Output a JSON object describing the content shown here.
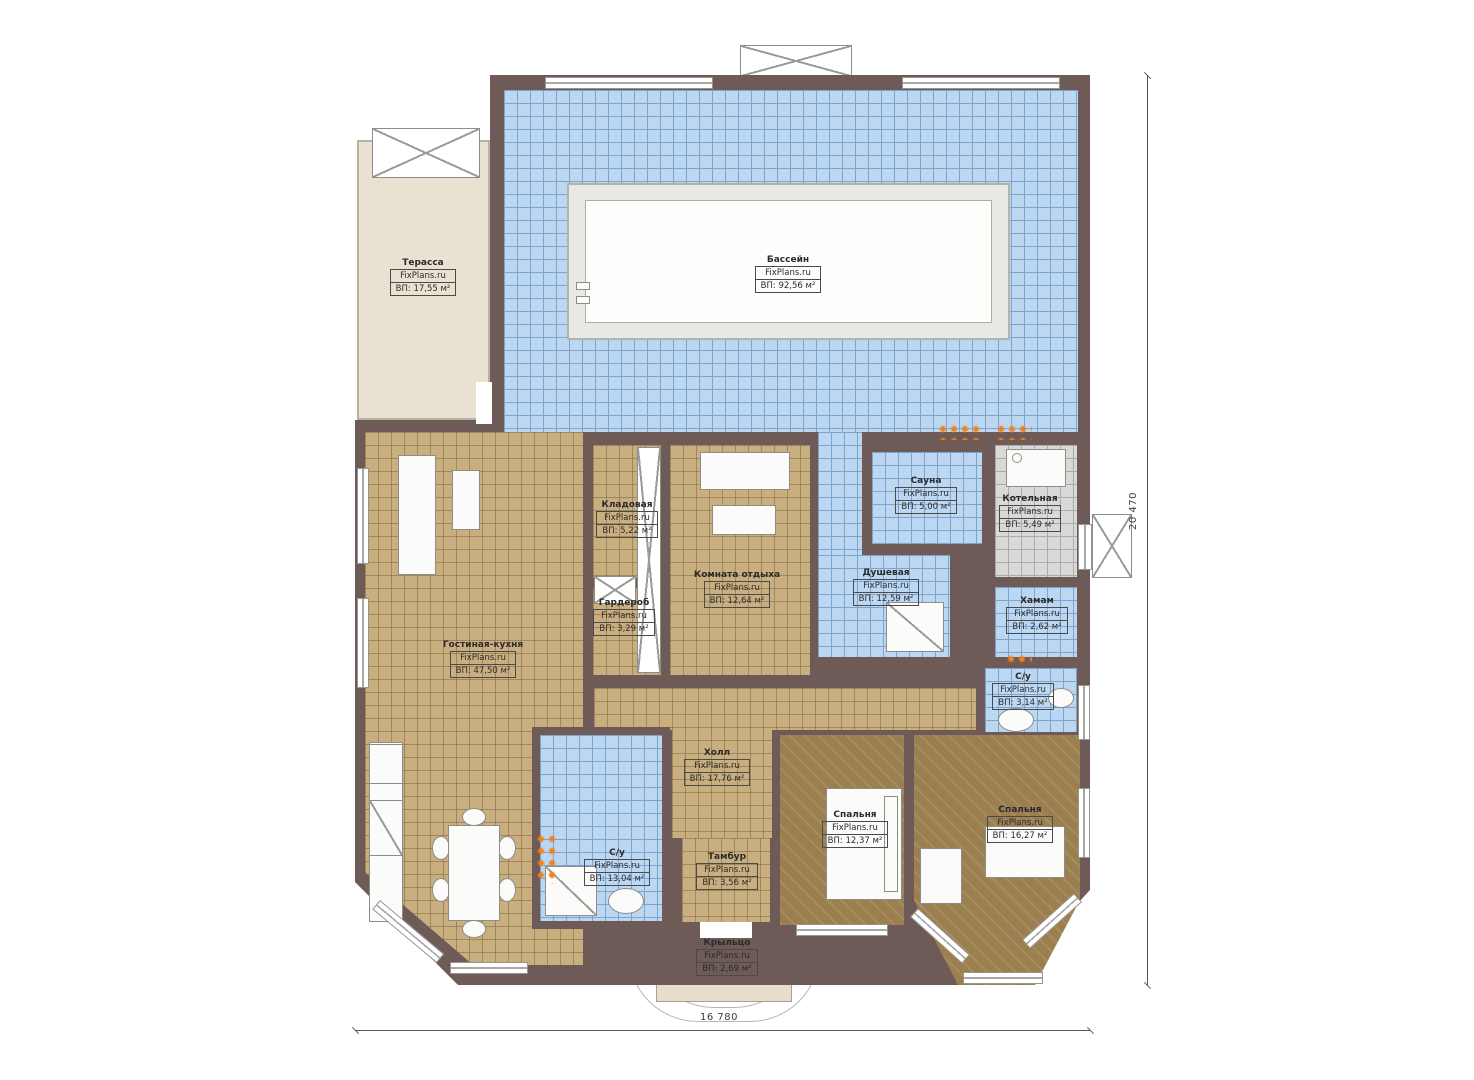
{
  "branding": {
    "site": "FixPlans.ru"
  },
  "dimensions": {
    "width_label": "16 780",
    "height_label": "20 470"
  },
  "colors": {
    "wall": "#6e5a56",
    "wet_tile": "#bcd7f1",
    "living_tile": "#c9ae80",
    "bedroom_floor": "#9c7f4f",
    "boiler_tile": "#d9d9d7",
    "terrace": "#e9e1d2",
    "radiator_dot": "#f08018"
  },
  "rooms": [
    {
      "id": "terrace",
      "name": "Терасса",
      "brand": "FixPlans.ru",
      "area": "ВП: 17,55 м²"
    },
    {
      "id": "pool",
      "name": "Бассейн",
      "brand": "FixPlans.ru",
      "area": "ВП: 92,56 м²"
    },
    {
      "id": "storage",
      "name": "Кладовая",
      "brand": "FixPlans.ru",
      "area": "ВП: 5,22 м²"
    },
    {
      "id": "lounge",
      "name": "Комната отдыха",
      "brand": "FixPlans.ru",
      "area": "ВП: 12,64 м²"
    },
    {
      "id": "sauna",
      "name": "Сауна",
      "brand": "FixPlans.ru",
      "area": "ВП: 5,00 м²"
    },
    {
      "id": "boiler",
      "name": "Котельная",
      "brand": "FixPlans.ru",
      "area": "ВП: 5,49 м²"
    },
    {
      "id": "shower",
      "name": "Душевая",
      "brand": "FixPlans.ru",
      "area": "ВП: 12,59 м²"
    },
    {
      "id": "hammam",
      "name": "Хамам",
      "brand": "FixPlans.ru",
      "area": "ВП: 2,62 м²"
    },
    {
      "id": "wardrobe",
      "name": "Гардероб",
      "brand": "FixPlans.ru",
      "area": "ВП: 3,29 м²"
    },
    {
      "id": "living",
      "name": "Гостиная-кухня",
      "brand": "FixPlans.ru",
      "area": "ВП: 47,50 м²"
    },
    {
      "id": "wc-right",
      "name": "С/у",
      "brand": "FixPlans.ru",
      "area": "ВП: 3,14 м²"
    },
    {
      "id": "hall",
      "name": "Холл",
      "brand": "FixPlans.ru",
      "area": "ВП: 17,76 м²"
    },
    {
      "id": "wc-left",
      "name": "С/у",
      "brand": "FixPlans.ru",
      "area": "ВП: 13,04 м²"
    },
    {
      "id": "vestibule",
      "name": "Тамбур",
      "brand": "FixPlans.ru",
      "area": "ВП: 3,56 м²"
    },
    {
      "id": "bedroom-1",
      "name": "Спальня",
      "brand": "FixPlans.ru",
      "area": "ВП: 12,37 м²"
    },
    {
      "id": "bedroom-2",
      "name": "Спальня",
      "brand": "FixPlans.ru",
      "area": "ВП: 16,27 м²"
    },
    {
      "id": "porch",
      "name": "Крыльцо",
      "brand": "FixPlans.ru",
      "area": "ВП: 2,69 м²"
    }
  ]
}
